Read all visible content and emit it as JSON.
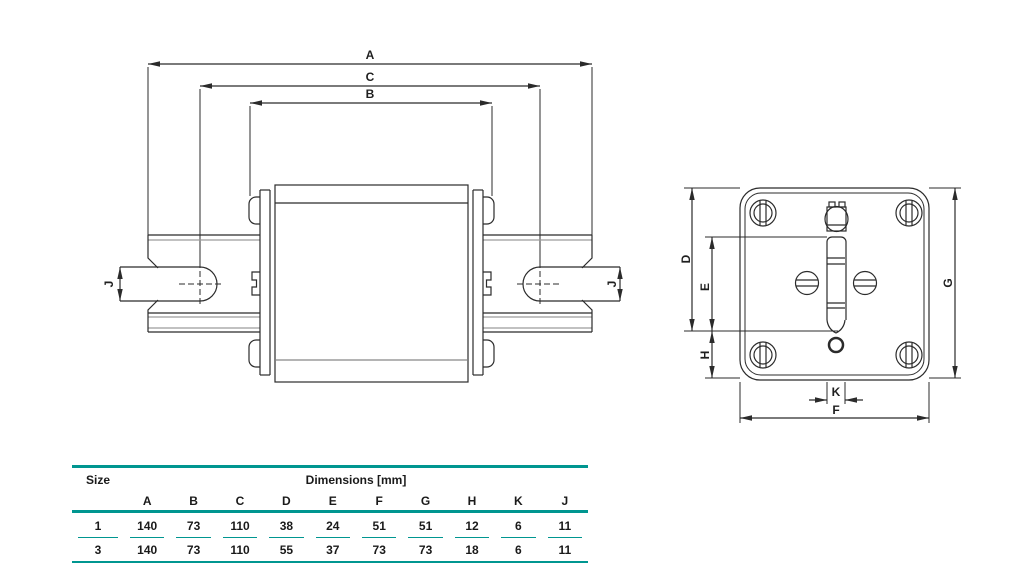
{
  "front_view": {
    "labels": {
      "a": "A",
      "c": "C",
      "b": "B",
      "j_left": "J",
      "j_right": "J"
    }
  },
  "side_view": {
    "labels": {
      "d": "D",
      "e": "E",
      "h": "H",
      "g": "G",
      "k": "K",
      "f": "F"
    }
  },
  "table": {
    "size_header": "Size",
    "dimensions_header": "Dimensions [mm]",
    "columns": [
      "A",
      "B",
      "C",
      "D",
      "E",
      "F",
      "G",
      "H",
      "K",
      "J"
    ],
    "rows": [
      {
        "size": "1",
        "values": [
          "140",
          "73",
          "110",
          "38",
          "24",
          "51",
          "51",
          "12",
          "6",
          "11"
        ]
      },
      {
        "size": "3",
        "values": [
          "140",
          "73",
          "110",
          "55",
          "37",
          "73",
          "73",
          "18",
          "6",
          "11"
        ]
      }
    ],
    "accent_color": "#009690"
  }
}
